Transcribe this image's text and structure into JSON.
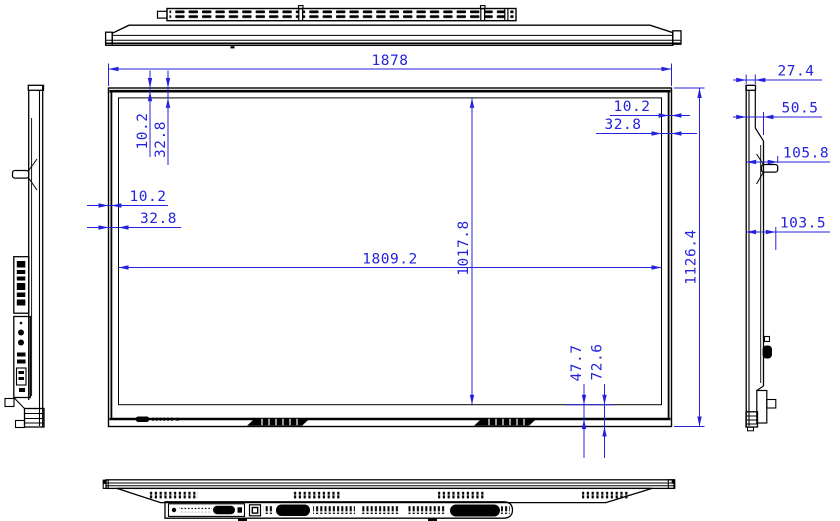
{
  "drawing": {
    "type": "dimensional-engineering-drawing",
    "subject": "flat-panel-display",
    "colors": {
      "line": "#000000",
      "dimension": "#2422dd",
      "background": "#ffffff"
    }
  },
  "dims": {
    "overall_width": "1878",
    "overall_height": "1126.4",
    "active_width": "1809.2",
    "active_height": "1017.8",
    "bezel_top_inner": "10.2",
    "bezel_top_outer": "32.8",
    "bezel_left_inner": "10.2",
    "bezel_left_outer": "32.8",
    "bezel_right_inner": "10.2",
    "bezel_right_outer": "32.8",
    "bezel_bottom_inner": "47.7",
    "bezel_bottom_outer": "72.6",
    "depth_panel": "27.4",
    "depth_body": "50.5",
    "depth_handle": "105.8",
    "depth_bottom_connector": "103.5"
  }
}
